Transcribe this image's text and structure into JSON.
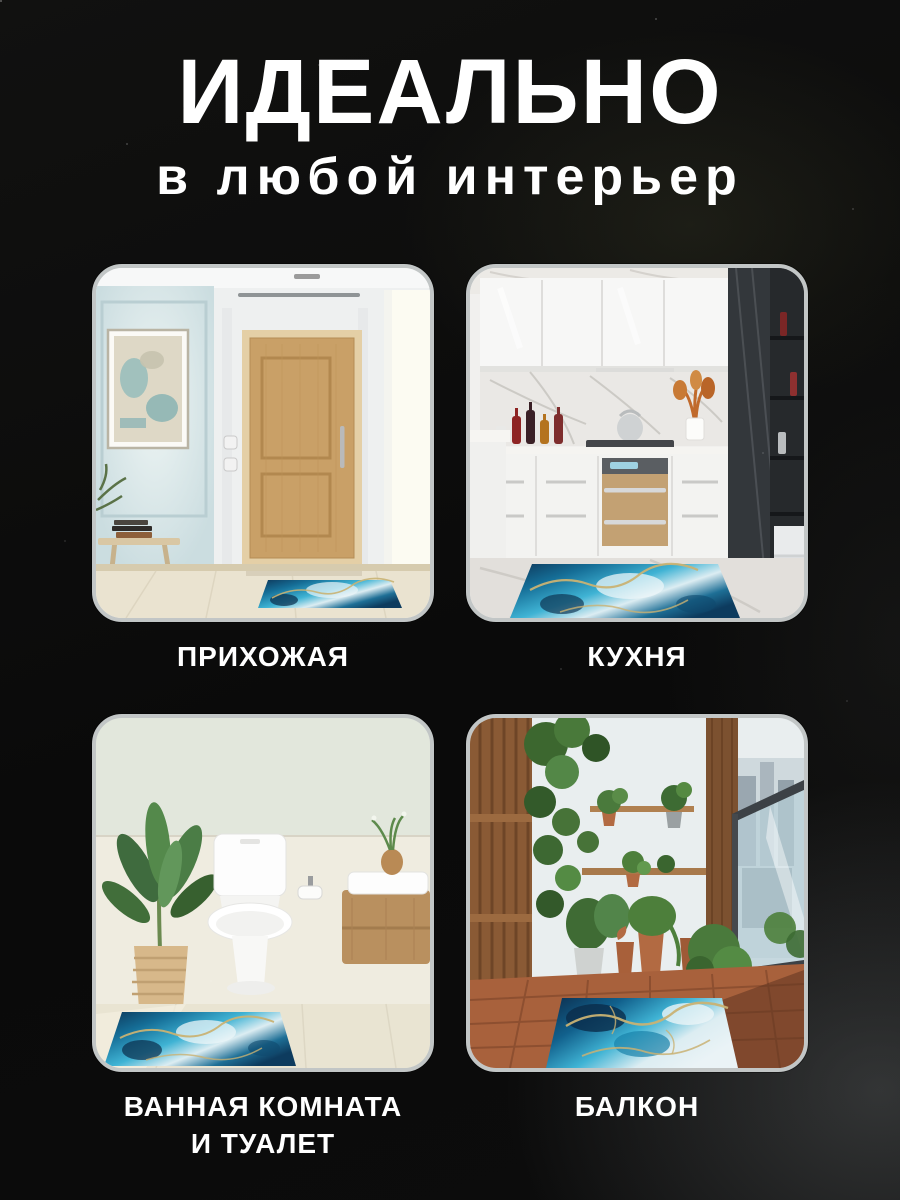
{
  "page": {
    "title": "ИДЕАЛЬНО",
    "subtitle": "в любой интерьер"
  },
  "cards": [
    {
      "id": "hallway",
      "label": "ПРИХОЖАЯ"
    },
    {
      "id": "kitchen",
      "label": "КУХНЯ"
    },
    {
      "id": "bathroom",
      "label": "ВАННАЯ КОМНАТА\nИ ТУАЛЕТ"
    },
    {
      "id": "balcony",
      "label": "БАЛКОН"
    }
  ],
  "palette": {
    "background": "#0b0b0b",
    "text": "#ffffff",
    "card_border": "#c2c6c6",
    "rug_navy": "#0d3557",
    "rug_teal": "#1a82aa",
    "rug_cyan": "#45bad7",
    "rug_white": "#e9f3f7",
    "rug_gold": "#c9b273"
  }
}
